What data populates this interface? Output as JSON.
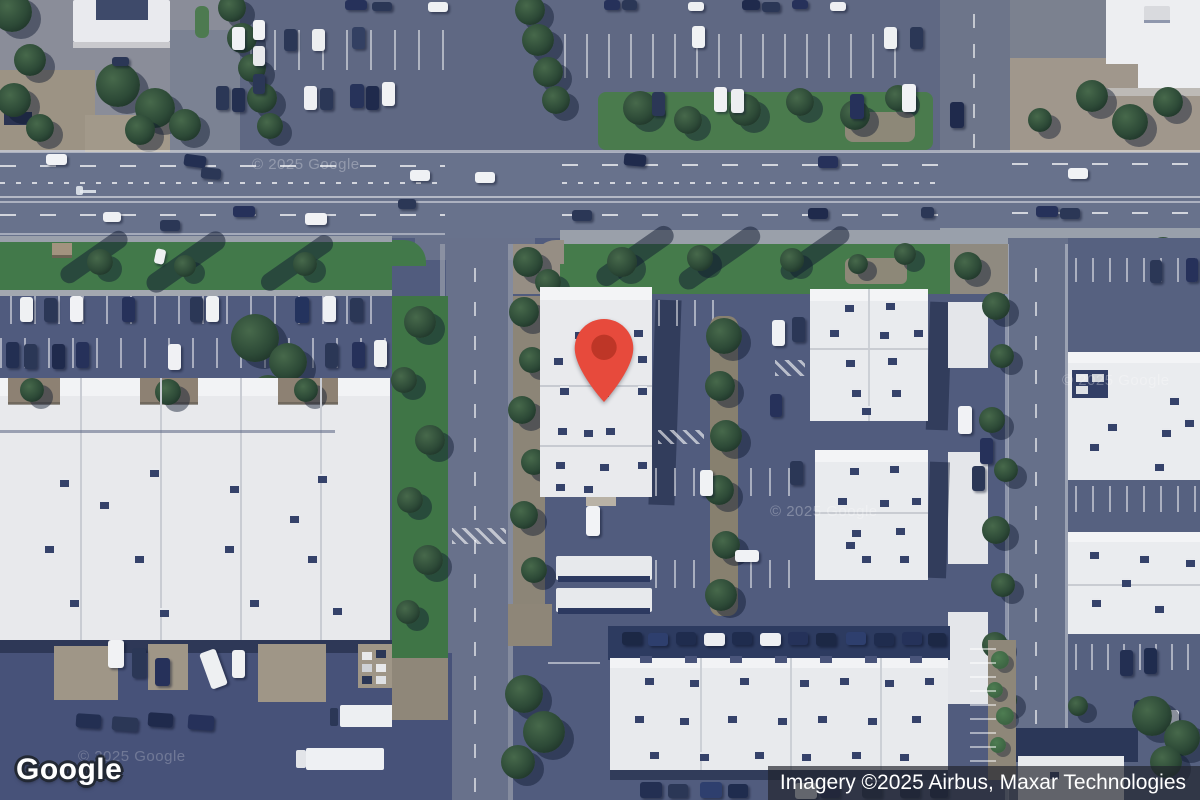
{
  "branding": {
    "logo_text": "Google"
  },
  "attribution": {
    "text": "Imagery ©2025 Airbus, Maxar Technologies"
  },
  "watermark": {
    "text": "© 2025 Google"
  },
  "marker": {
    "color": "#E74A3C",
    "inner_color": "#BE3627"
  }
}
